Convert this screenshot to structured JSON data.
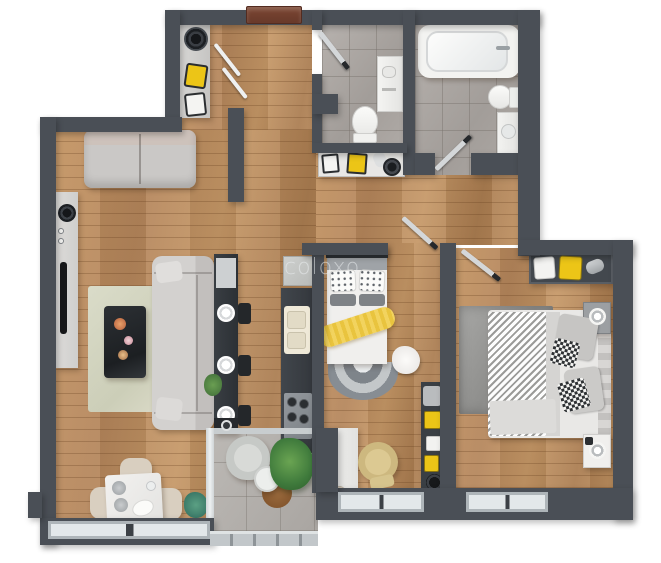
{
  "watermark": {
    "text": "coloxo"
  },
  "plan": {
    "type": "apartment-3d-floor-plan-top-view",
    "rooms": [
      {
        "name": "entrance-hall",
        "floor": "wood",
        "items": [
          "entrance-door",
          "console-shelf",
          "decor-hat",
          "yellow-box",
          "white-box",
          "open-closet-doors"
        ]
      },
      {
        "name": "living-room",
        "floor": "wood",
        "items": [
          "loveseat-sofa",
          "tv-sideboard",
          "tv",
          "round-speaker",
          "area-rug",
          "coffee-table-with-flowers",
          "sofa",
          "bar-counter",
          "bar-plates",
          "bar-stools",
          "bar-plant",
          "dining-table",
          "dining-chairs",
          "decor-plant"
        ]
      },
      {
        "name": "kitchen",
        "floor": "wood",
        "items": [
          "fridge",
          "counter-run",
          "double-sink",
          "cooktop"
        ]
      },
      {
        "name": "wc",
        "floor": "tile",
        "items": [
          "toilet",
          "washbasin-cabinet",
          "door"
        ]
      },
      {
        "name": "bathroom",
        "floor": "tile",
        "items": [
          "bathtub",
          "toilet",
          "washbasin-cabinet",
          "door"
        ]
      },
      {
        "name": "hallway",
        "floor": "wood",
        "items": [
          "console-shelf",
          "white-box",
          "yellow-box",
          "towel-roll",
          "decor-hat"
        ]
      },
      {
        "name": "bedroom-center",
        "floor": "wood",
        "items": [
          "double-bed",
          "dotted-pillows",
          "yellow-throw",
          "semicircle-rug",
          "fur-pouf",
          "desk",
          "desk-chair",
          "wall-shelf",
          "yellow-boxes",
          "black-round-box",
          "window",
          "door"
        ]
      },
      {
        "name": "bedroom-right",
        "floor": "wood",
        "items": [
          "double-bed",
          "striped-duvet",
          "checkered-pillows",
          "gray-pillows",
          "area-rug",
          "nightstand-top",
          "nightstand-bottom",
          "wall-shelf",
          "folded-towels",
          "window",
          "door"
        ]
      },
      {
        "name": "balcony",
        "floor": "tile",
        "items": [
          "wicker-armchair",
          "round-side-table",
          "potted-plant",
          "round-mat",
          "railing"
        ]
      }
    ]
  },
  "palette": {
    "wall": "#4a4f56",
    "wood_floor": "#b98a5a",
    "tile_floor": "#aba6a2",
    "accent_yellow": "#ecc517",
    "entry_door_brown": "#74412f",
    "counter_dark": "#3c4147",
    "furniture_gray": "#cac8c6",
    "rug_green": "#d5d6c2",
    "plant_green": "#4e7d44"
  }
}
